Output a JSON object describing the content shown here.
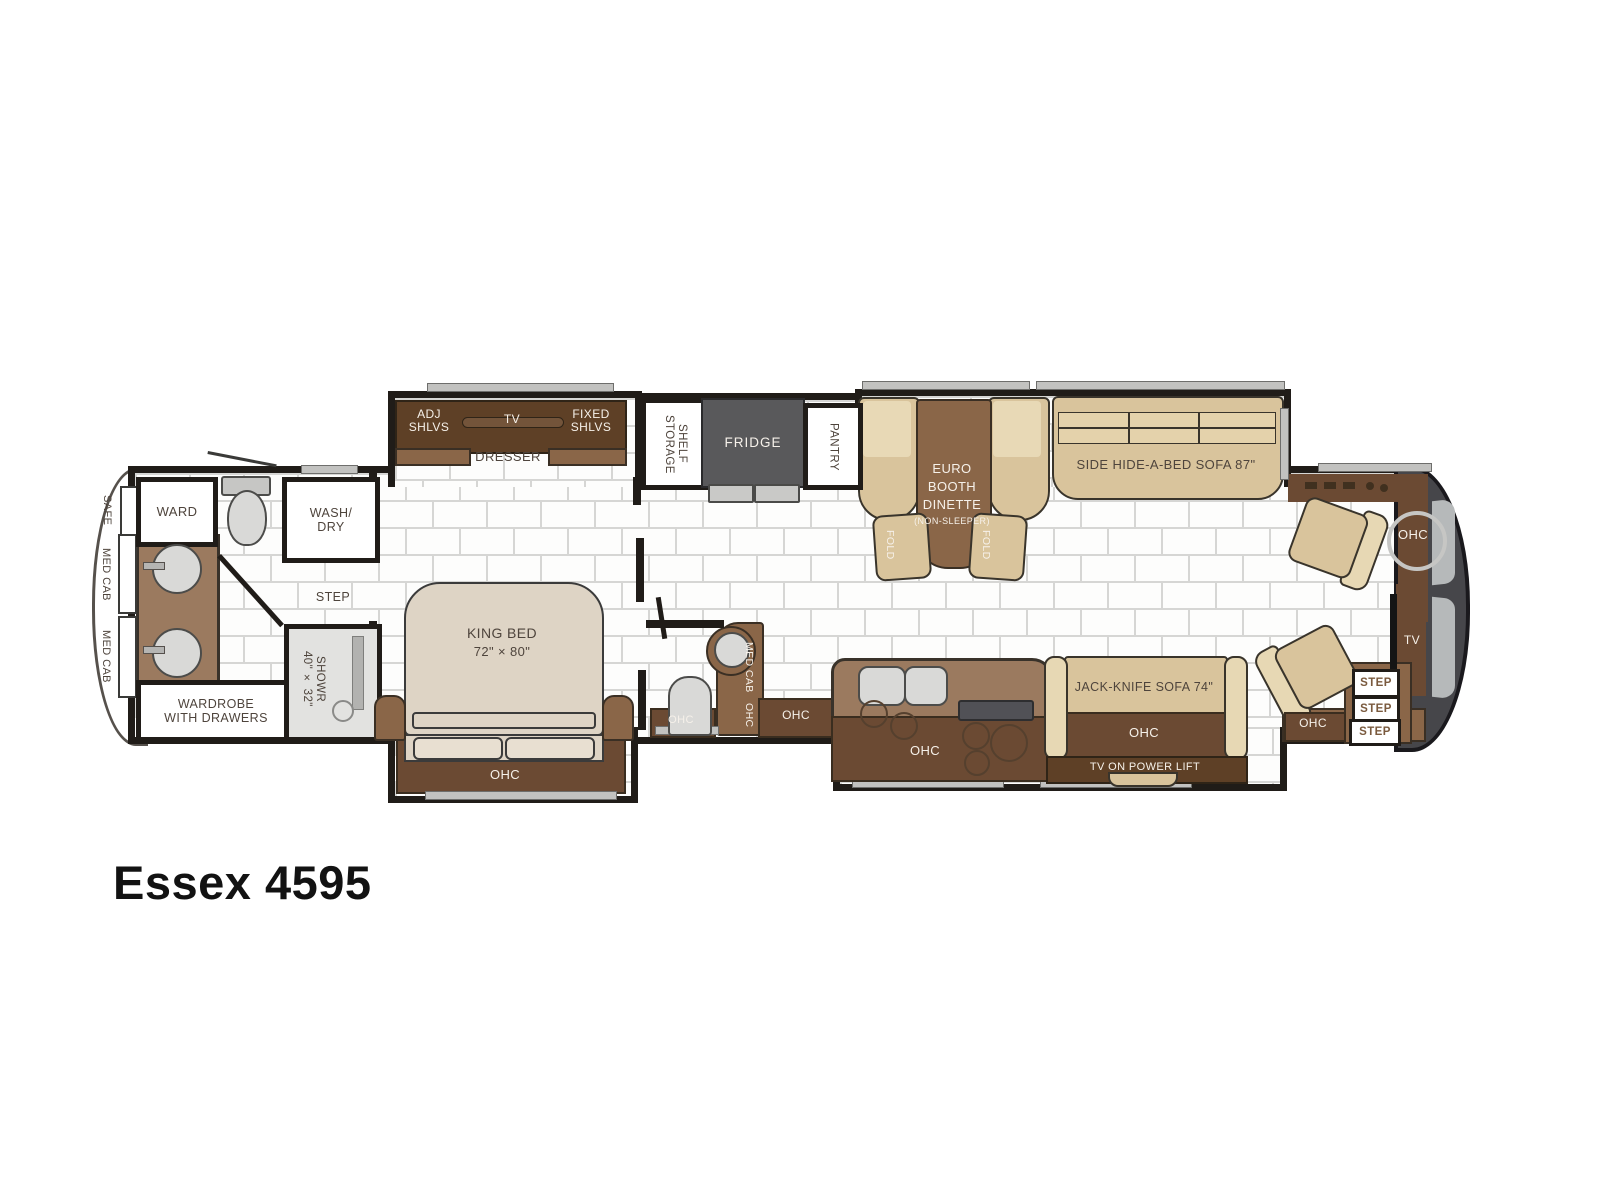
{
  "title": "Essex 4595",
  "plan": {
    "rear": {
      "safe": "SAFE",
      "med_cab_1": "MED CAB",
      "med_cab_2": "MED CAB",
      "ward": "WARD",
      "wash_dry": "WASH/\nDRY",
      "step": "STEP",
      "shower": "SHOWR\n40\" × 32\"",
      "wardrobe": "WARDROBE\nWITH DRAWERS"
    },
    "bedroom": {
      "adj_shlvs": "ADJ\nSHLVS",
      "tv": "TV",
      "fixed_shlvs": "FIXED\nSHLVS",
      "dresser": "DRESSER",
      "king_bed": "KING BED",
      "king_size": "72\" × 80\"",
      "ohc": "OHC"
    },
    "half_bath": {
      "med_cab": "MED CAB",
      "ohc_vertical": "OHC",
      "ohc_toilet": "OHC",
      "ohc_side": "OHC"
    },
    "galley": {
      "shelf_storage": "SHELF\nSTORAGE",
      "fridge": "FRIDGE",
      "pantry": "PANTRY"
    },
    "dinette": {
      "line1": "EURO",
      "line2": "BOOTH",
      "line3": "DINETTE",
      "line4": "(NON-SLEEPER)",
      "fold_left": "FOLD",
      "fold_right": "FOLD"
    },
    "living": {
      "hide_a_bed_sofa": "SIDE HIDE-A-BED SOFA 87\""
    },
    "kitchen": {
      "ohc": "OHC"
    },
    "tv_wall": {
      "jack_knife_sofa": "JACK-KNIFE SOFA 74\"",
      "ohc": "OHC",
      "tv_power_lift": "TV ON POWER LIFT"
    },
    "cockpit": {
      "ohc_dash": "OHC",
      "tv": "TV",
      "step_1": "STEP",
      "step_2": "STEP",
      "step_3": "STEP",
      "ohc_entry": "OHC"
    }
  },
  "colors": {
    "wall": "#201c18",
    "cabinet_dark": "#5e4026",
    "cabinet_mid": "#8a6648",
    "counter": "#9b7a5f",
    "ohc_overlay": "#6b4a33",
    "upholstery_tan": "#d9c49c",
    "fridge_gray": "#59595b",
    "front_cap_gray": "#46464a",
    "floor_grout": "#d6d6d4",
    "label_dark": "#4e443c",
    "label_light": "#f6f1ea"
  }
}
